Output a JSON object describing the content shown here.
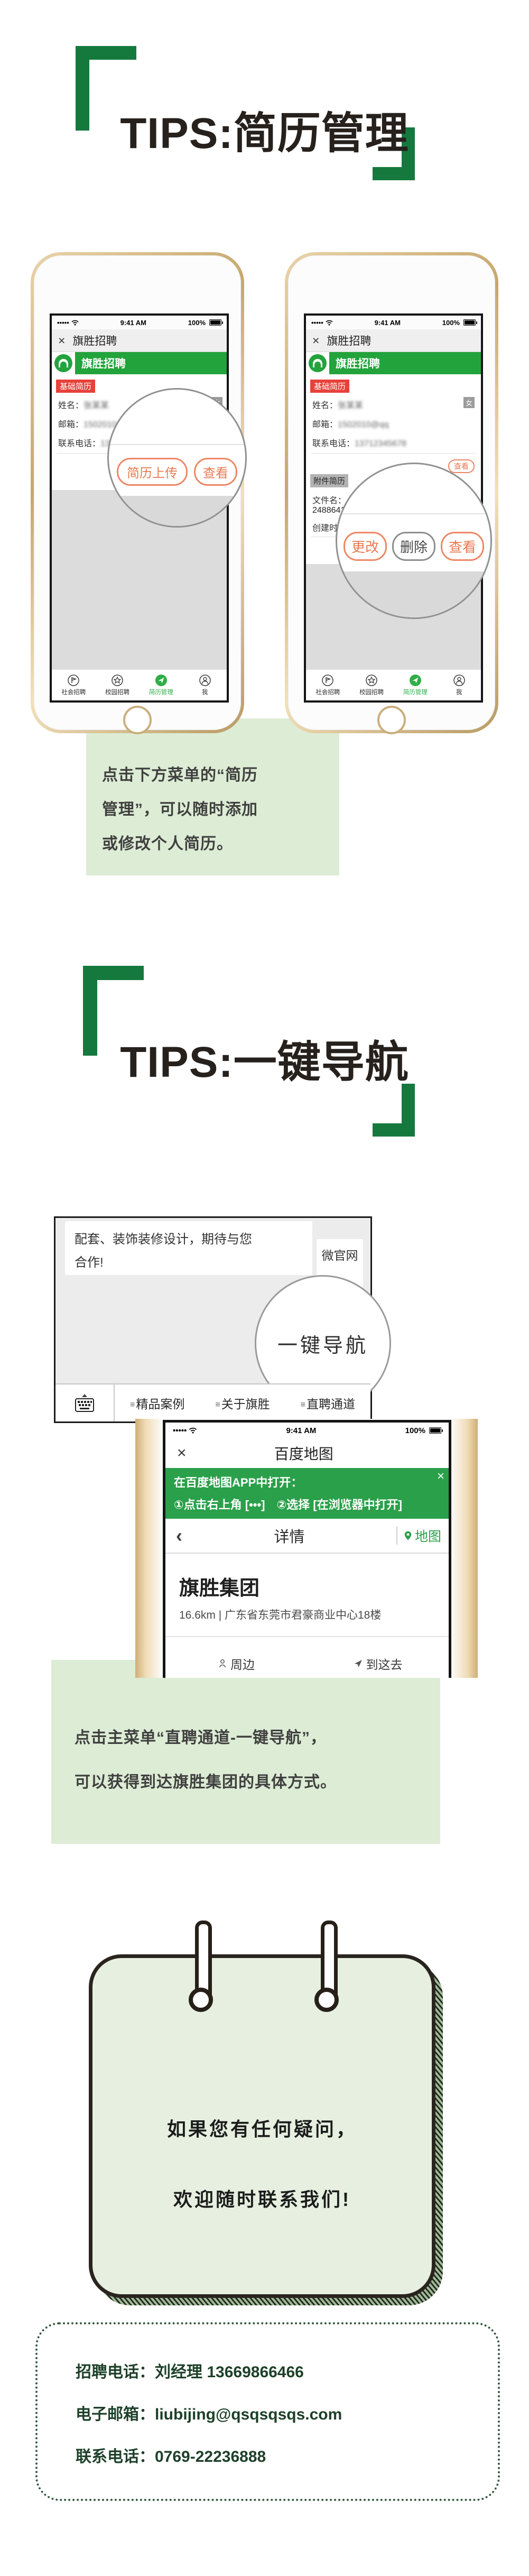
{
  "titles": {
    "tip1": "TIPS:简历管理",
    "tip2": "TIPS:一键导航"
  },
  "colors": {
    "bracket_green": "#15793e",
    "wechat_green": "#23a33c",
    "baidu_banner_green": "#2aa04a",
    "tag_red": "#e8413a",
    "button_orange": "#ee8663",
    "note_bg": "#ddecd5",
    "notepad_bg": "#e7f0e0",
    "contact_green": "#1d4029",
    "tab_active_green": "#2fae47"
  },
  "statusbar": {
    "signal": "•••••",
    "time": "9:41 AM",
    "battery": "100%"
  },
  "wechat_nav": {
    "close": "×",
    "title": "旗胜招聘"
  },
  "account_header": {
    "title": "旗胜招聘"
  },
  "resume_form": {
    "section_basic": "基础简历",
    "name_label": "姓名：",
    "name_value_blur": "张某某",
    "gender_tag": "女",
    "email_label": "邮箱：",
    "email_value_blur": "1502010@qq",
    "phone_label": "联系电话：",
    "phone_value_blur": "13712345678",
    "view_btn": "查看",
    "section_attach": "附件简历",
    "file_label": "文件名：",
    "file_value_blur": "...p-",
    "file_value_visible": "2488641.htm",
    "created_label": "创建时间：",
    "created_value_blur": "2019-05-20"
  },
  "magnifier_left": {
    "upload_btn": "简历上传",
    "view_btn": "查看"
  },
  "magnifier_right": {
    "change_btn": "更改",
    "delete_btn": "删除",
    "view_btn": "查看"
  },
  "tabbar": {
    "items": [
      {
        "label": "社会招聘"
      },
      {
        "label": "校园招聘"
      },
      {
        "label": "简历管理"
      },
      {
        "label": "我"
      }
    ]
  },
  "tip1_note": {
    "lines": [
      "点击下方菜单的“简历",
      "管理”，可以随时添加",
      "或修改个人简历。"
    ]
  },
  "chat": {
    "bubble_line1": "配套、装饰装修设计，期待与您",
    "bubble_line2": "合作!",
    "popup_item1": "微官网",
    "popup_item2_partial": "东方",
    "magnifier_label": "一键导航",
    "menu_hamburger": "≡",
    "menu1": "精品案例",
    "menu2": "关于旗胜",
    "menu3": "直聘通道"
  },
  "map_phone": {
    "nav_close": "×",
    "nav_title": "百度地图",
    "banner_line1": "在百度地图APP中打开：",
    "banner_line2": "①点击右上角 [•••]　②选择 [在浏览器中打开]",
    "banner_close": "×",
    "subnav_back": "‹",
    "subnav_title": "详情",
    "subnav_map": "地图",
    "poi_name": "旗胜集团",
    "poi_address": "16.6km | 广东省东莞市君豪商业中心18楼",
    "action_around": "周边",
    "action_goto": "到这去"
  },
  "tip2_note": {
    "lines": [
      "点击主菜单“直聘通道-一键导航”，",
      "可以获得到达旗胜集团的具体方式。"
    ]
  },
  "notepad": {
    "lines": [
      "如果您有任何疑问，",
      "欢迎随时联系我们!"
    ]
  },
  "contact": {
    "line1_label": "招聘电话：",
    "line1_value": "刘经理 13669866466",
    "line2_label": "电子邮箱：",
    "line2_value": "liubijing@qsqsqsqs.com",
    "line3_label": "联系电话：",
    "line3_value": "0769-22236888"
  }
}
